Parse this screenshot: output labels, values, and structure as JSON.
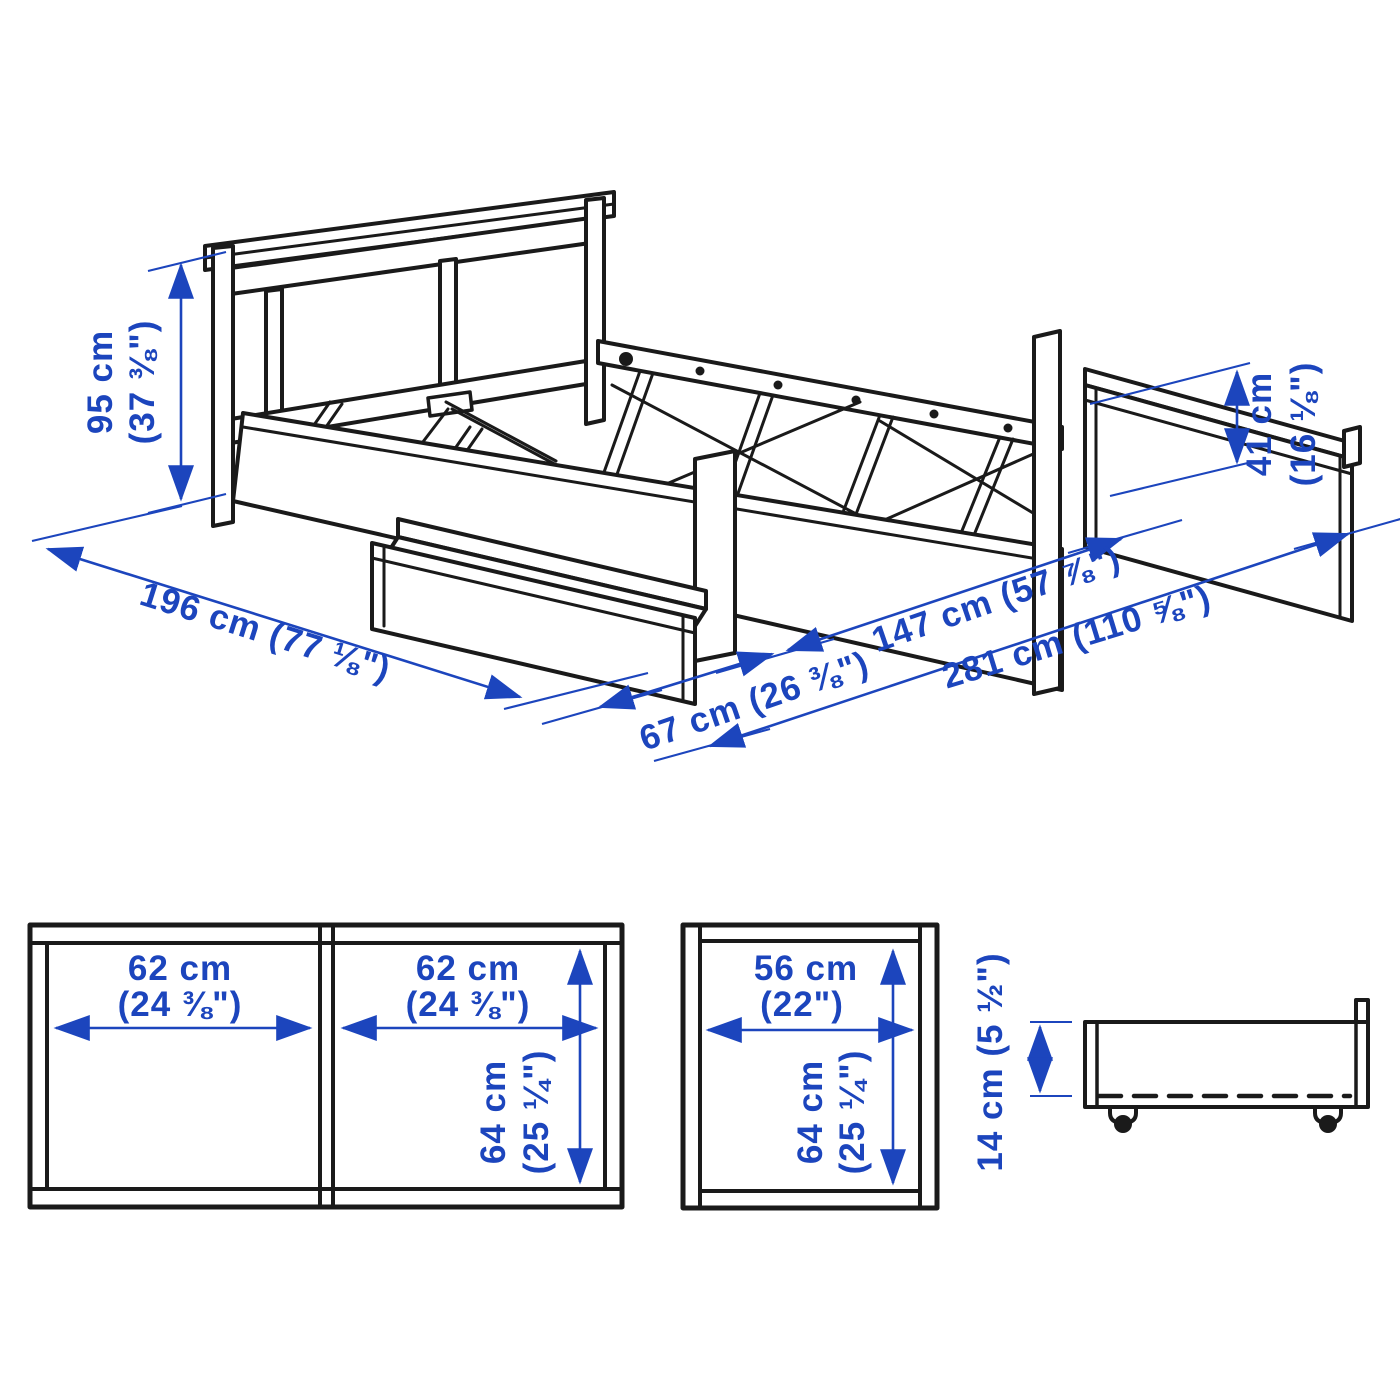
{
  "diagram": {
    "kind": "furniture-dimension-diagram",
    "subject": "bed frame with underbed storage boxes",
    "colors": {
      "dimension_blue": "#1c45bd",
      "line_black": "#1a1a1a",
      "background": "#ffffff"
    }
  },
  "iso_view": {
    "headboard_height": {
      "line1": "95 cm",
      "line2": "(37 ⅜\")"
    },
    "storage_side_height": {
      "line1": "41 cm",
      "line2": "(16 ⅛\")"
    },
    "bed_length": "196 cm (77 ⅛\")",
    "drawer_pullout": "67 cm (26 ⅜\")",
    "bed_width": "147 cm (57 ⅞\")",
    "total_clearance_width": "281 cm (110 ⅝\")"
  },
  "storage_box_top_view": {
    "left_compartment_width": {
      "line1": "62 cm",
      "line2": "(24 ⅜\")"
    },
    "right_compartment_width": {
      "line1": "62 cm",
      "line2": "(24 ⅜\")"
    },
    "depth": {
      "line1": "64 cm",
      "line2": "(25 ¼\")"
    }
  },
  "single_box_top_view": {
    "width": {
      "line1": "56 cm",
      "line2": "(22\")"
    },
    "depth": {
      "line1": "64 cm",
      "line2": "(25 ¼\")"
    }
  },
  "drawer_side_view": {
    "height": "14 cm (5 ½\")"
  }
}
